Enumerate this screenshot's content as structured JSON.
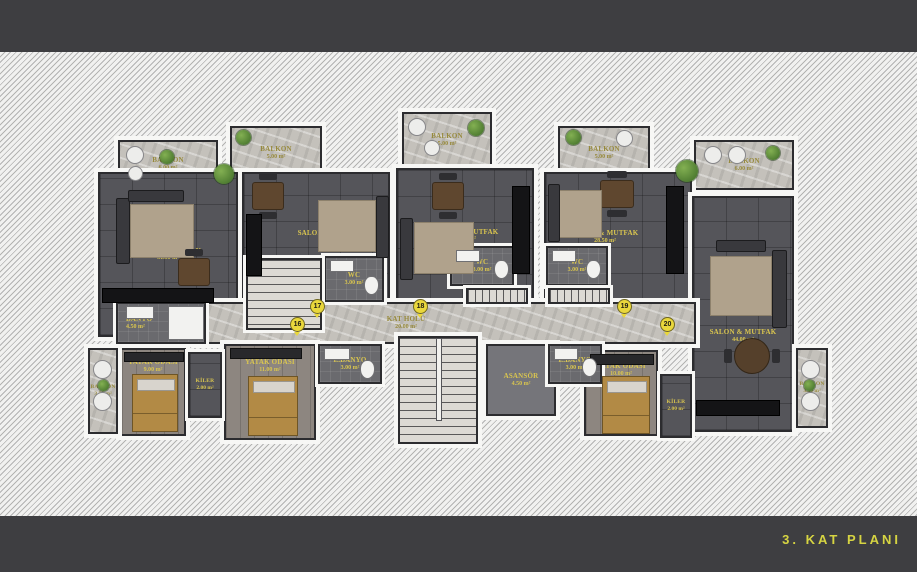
{
  "footer": {
    "title": "3. KAT PLANI"
  },
  "colors": {
    "background": "#3e3e41",
    "label_gold": "#d9c54f",
    "title_yellow": "#d6d442",
    "floor_dark": "#55555a",
    "floor_stone": "#c4c1bb"
  },
  "rooms": {
    "balkon_t1": {
      "name": "BALKON",
      "area": "6.00 m²"
    },
    "balkon_t2": {
      "name": "BALKON",
      "area": "5.00 m²"
    },
    "balkon_t3": {
      "name": "BALKON",
      "area": "5.00 m²"
    },
    "balkon_t4": {
      "name": "BALKON",
      "area": "5.00 m²"
    },
    "balkon_t5": {
      "name": "BALKON",
      "area": "6.00 m²"
    },
    "salon1": {
      "name": "SALON & MUTFAK",
      "area": "31.50 m²"
    },
    "salon2": {
      "name": "SALON & MUTFAK",
      "area": "29.00 m²"
    },
    "salon3": {
      "name": "SALON & MUTFAK",
      "area": "24.50 m²"
    },
    "salon4": {
      "name": "SALON & MUTFAK",
      "area": "28.50 m²"
    },
    "salon5": {
      "name": "SALON & MUTFAK",
      "area": "44.00 m²"
    },
    "wc2": {
      "name": "WC",
      "area": "3.00 m²"
    },
    "wc3": {
      "name": "WC",
      "area": "3.00 m²"
    },
    "wc4": {
      "name": "WC",
      "area": "3.00 m²"
    },
    "banyo1": {
      "name": "BANYO",
      "area": "4.50 m²"
    },
    "ebanyo2": {
      "name": "E.BANYO",
      "area": "3.00 m²"
    },
    "ebanyo4": {
      "name": "E.BANYO",
      "area": "3.00 m²"
    },
    "yatak1": {
      "name": "YATAK ODASI",
      "area": "9.00 m²"
    },
    "yatak2": {
      "name": "YATAK ODASI",
      "area": "11.00 m²"
    },
    "yatak4": {
      "name": "YATAK ODASI",
      "area": "10.00 m²"
    },
    "kiler1": {
      "name": "KİLER",
      "area": "2.00 m²"
    },
    "kiler4": {
      "name": "KİLER",
      "area": "2.00 m²"
    },
    "balkon_l": {
      "name": "BALKON",
      "area": "3.50 m²"
    },
    "balkon_r": {
      "name": "BALKON",
      "area": "3.50 m²"
    },
    "hol": {
      "name": "KAT HOLÜ",
      "area": "20.00 m²"
    },
    "asansor": {
      "name": "ASANSÖR",
      "area": "4.50 m²"
    }
  },
  "doors": {
    "d16": "16",
    "d17": "17",
    "d18": "18",
    "d19": "19",
    "d20": "20"
  }
}
